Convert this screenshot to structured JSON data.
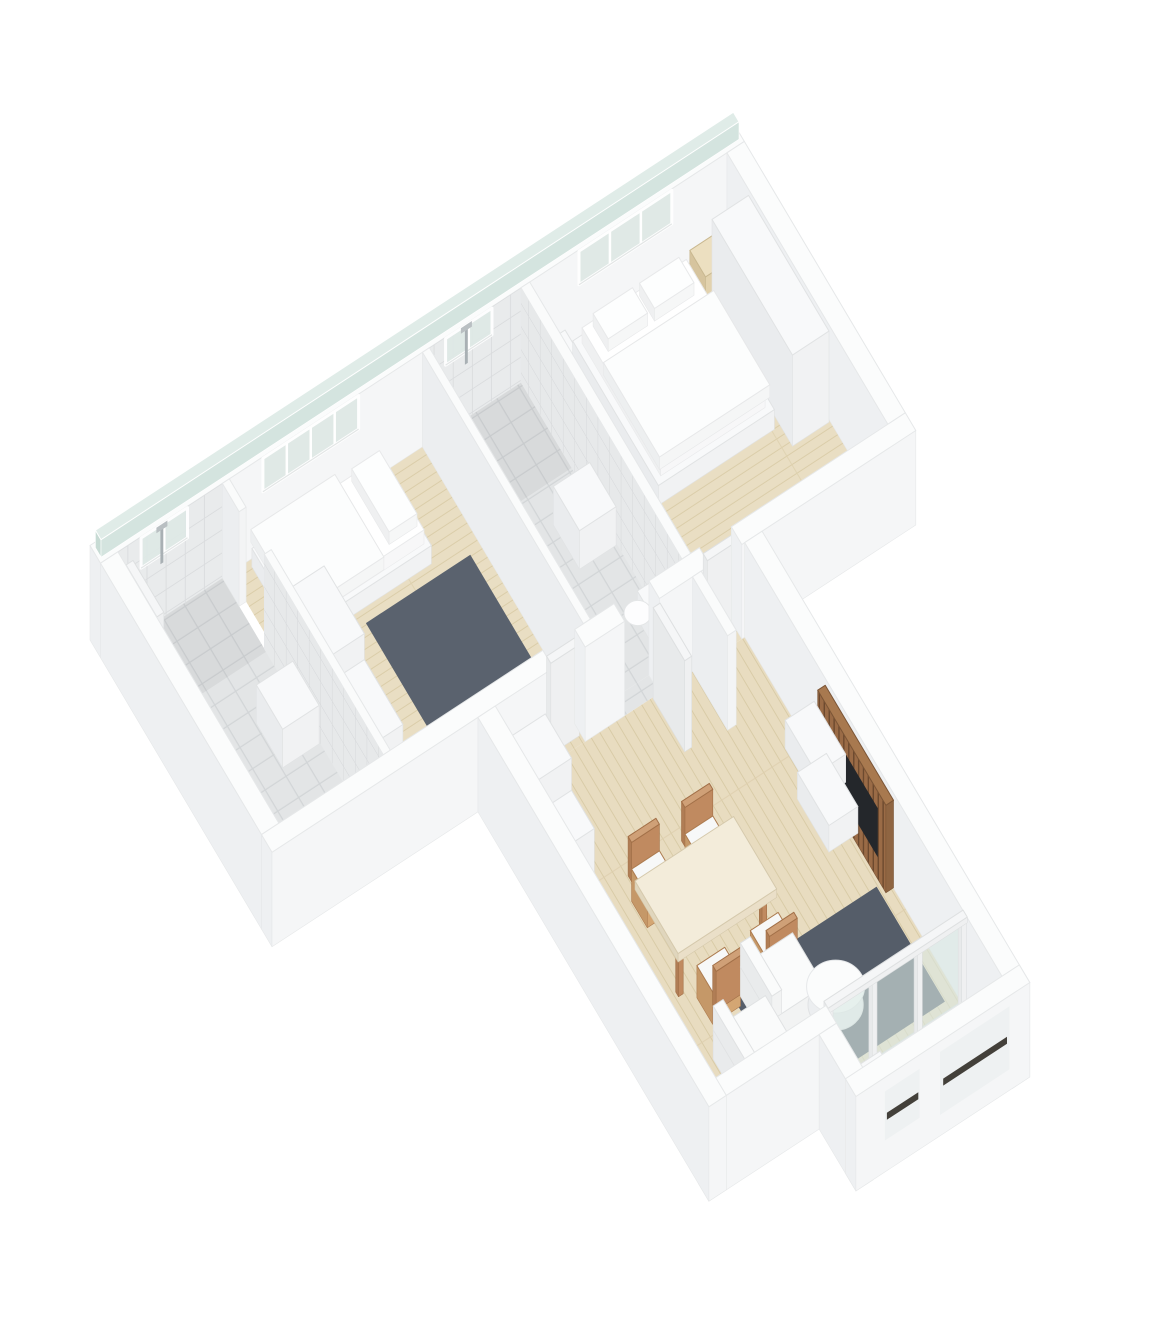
{
  "meta": {
    "title": "apartment-3d-floor-plan-render",
    "background": "#ffffff",
    "canvas": {
      "w": 1170,
      "h": 1332
    },
    "depicted_rooms": [
      "bathroom-1",
      "bedroom-2",
      "bathroom-2",
      "master-bedroom",
      "entry-hallway",
      "living-dining-room",
      "loggia-balcony"
    ]
  },
  "projection": {
    "origin": [
      90,
      640
    ],
    "eu": [
      58,
      -38
    ],
    "ev": [
      35,
      59
    ],
    "ez": 70
  },
  "palette": {
    "fills": {
      "tile": "url(#tileF)",
      "tileD": "url(#tileFd)",
      "woodU": "url(#woodU)",
      "woodV": "url(#woodV)",
      "deck": "url(#deck)",
      "rug": "#5a626e",
      "rug2": "#555d69",
      "tileWV": "url(#tileWV)",
      "tileWU": "url(#tileWU)",
      "glassP": "#d9e7e3"
    },
    "styles": {
      "ext": {
        "t": "#fbfcfc",
        "m": "#eef0f2",
        "p": "#f5f6f7",
        "s": "#e6e8e9"
      },
      "wallI": {
        "t": "#fafbfb",
        "m": "#eceef0",
        "p": "#f3f4f5",
        "s": "#e6e8e9"
      },
      "furn": {
        "t": "#f8f9fa",
        "m": "#eaecee",
        "p": "#f1f2f3",
        "s": "#e1e3e4"
      },
      "doorw": {
        "t": "#f5f6f7",
        "m": "#e8eaeb",
        "p": "#eff0f1",
        "s": "#dee0e1"
      },
      "bedw": {
        "t": "#ffffff",
        "m": "#eff0f1",
        "p": "#f7f7f8",
        "s": "#e9eaeb"
      },
      "duv": {
        "t": "#fcfdfd",
        "m": "#edeff0",
        "p": "#f5f6f6",
        "s": "#e7e8e9"
      },
      "pil": {
        "t": "#fdfefe",
        "m": "#eff0f1",
        "p": "#f6f7f7",
        "s": "#e8e9ea"
      },
      "woodf": {
        "t": "#ecdfc0",
        "m": "#d6c49e",
        "p": "#e2d2ae",
        "s": "#c9b890"
      },
      "tan": {
        "t": "#cfa077",
        "m": "#b07d55",
        "p": "#c08a60",
        "s": "#a27048"
      },
      "chair": {
        "t": "#f7f8f8",
        "m": "#c59868",
        "p": "#d4a673",
        "s": "#ad7c50"
      },
      "cloth": {
        "t": "#f3ecda",
        "m": "#e0d6bd",
        "p": "#eadfc8",
        "s": "#d5c9ac"
      },
      "sofaw": {
        "t": "#fafbfb",
        "m": "#e9ebec",
        "p": "#f2f3f3",
        "s": "#e0e2e3"
      },
      "slat": {
        "t": "#a8794f",
        "m": "url(#slats)",
        "p": "#8f6542",
        "s": "#7b5536"
      },
      "glassS": {
        "t": "#e0ece8",
        "m": "#c7dbd4",
        "p": "#d4e4df",
        "s": "#ffffff"
      }
    },
    "window": {
      "glass": "#dfe9e6",
      "frame": "#ffffff",
      "sill": "#e3e6e6"
    }
  },
  "scene": [
    [
      "floor",
      "bathroom1-floor",
      0.3,
      0.3,
      2.1,
      4.9,
      "tile"
    ],
    [
      "floor",
      "bathroom1-shower-floor",
      0.3,
      0.3,
      2.1,
      1.55,
      "tileD"
    ],
    [
      "floor",
      "bedroom2-floor",
      2.22,
      0.3,
      5.55,
      4.9,
      "woodU"
    ],
    [
      "floor",
      "bathroom2-floor",
      5.67,
      0.3,
      7.25,
      4.9,
      "tile"
    ],
    [
      "floor",
      "bathroom2-shower-floor",
      5.67,
      0.3,
      7.25,
      1.75,
      "tileD"
    ],
    [
      "floor",
      "master-bedroom-floor",
      7.4,
      0.3,
      10.8,
      4.9,
      "woodU"
    ],
    [
      "floor",
      "hall-living-floor",
      3.85,
      5.2,
      8.15,
      11.5,
      "woodV"
    ],
    [
      "floor",
      "doorway-strip-bedroom2",
      4.85,
      4.9,
      5.4,
      5.2,
      "woodV"
    ],
    [
      "floor",
      "doorway-strip-bathroom2",
      6.08,
      4.9,
      6.68,
      5.2,
      "tile"
    ],
    [
      "floor",
      "doorway-strip-master",
      7.55,
      4.9,
      8.1,
      5.2,
      "woodU"
    ],
    [
      "floor",
      "loggia-deck",
      5.75,
      11.5,
      8.15,
      12.55,
      "deck"
    ],
    [
      "floor",
      "bedroom2-rug",
      3.55,
      2.0,
      5.35,
      4.45,
      "rug"
    ],
    [
      "floor",
      "living-room-rug",
      5.35,
      9.3,
      7.95,
      11.25,
      "rug2"
    ],
    [
      "box",
      "north-wall",
      0,
      0,
      11.1,
      0.3,
      0,
      1.35,
      "ext"
    ],
    [
      "box",
      "glass-strip",
      0.05,
      0.07,
      11.05,
      0.23,
      1.35,
      1.6,
      "glassS"
    ],
    [
      "faceV",
      "bathroom1-wall-tiles",
      0.3,
      0.3,
      0,
      2.1,
      1.35,
      "tileWV",
      1
    ],
    [
      "faceV",
      "bathroom2-wall-tiles",
      0.3,
      5.67,
      0,
      7.25,
      1.35,
      "tileWV",
      1
    ],
    [
      "winV",
      "bathroom1-window",
      0.3,
      0.7,
      1.5,
      0.9,
      1.33,
      1
    ],
    [
      "winV",
      "bedroom2-window",
      0.3,
      2.8,
      4.45,
      0.85,
      1.33,
      3
    ],
    [
      "winV",
      "bathroom2-window",
      0.3,
      5.95,
      6.75,
      0.95,
      1.33,
      1
    ],
    [
      "winV",
      "master-bedroom-window",
      0.3,
      8.25,
      9.85,
      0.85,
      1.33,
      2
    ],
    [
      "faceV",
      "shower-rod-bathroom1",
      0.305,
      1.03,
      0.78,
      1.08,
      1.32,
      "#a9b0b4",
      1
    ],
    [
      "faceV",
      "shower-head-bathroom1",
      0.305,
      0.96,
      1.26,
      1.15,
      1.34,
      "#b9bfc2",
      1
    ],
    [
      "faceV",
      "shower-rod-bathroom2",
      0.305,
      6.28,
      0.78,
      6.33,
      1.32,
      "#a9b0b4",
      1
    ],
    [
      "faceV",
      "shower-head-bathroom2",
      0.305,
      6.21,
      1.26,
      6.4,
      1.34,
      "#b9bfc2",
      1
    ],
    [
      "box",
      "east-wall",
      10.8,
      0.3,
      11.1,
      4.9,
      0,
      1.35,
      "ext"
    ],
    [
      "box",
      "master-nightstand-left",
      7.55,
      0.4,
      7.95,
      0.85,
      0,
      0.45,
      "furn"
    ],
    [
      "box",
      "master-nightstand-right",
      10.1,
      0.4,
      10.5,
      0.85,
      0,
      0.42,
      "woodf"
    ],
    [
      "box",
      "master-wardrobe",
      10.15,
      0.95,
      10.78,
      3.25,
      0,
      1.3,
      "furn"
    ],
    [
      "box",
      "master-bed-frame",
      8.05,
      0.45,
      10.05,
      2.9,
      0,
      0.28,
      "furn"
    ],
    [
      "box",
      "master-bed-mattress",
      8.15,
      0.55,
      9.95,
      2.8,
      0.28,
      0.5,
      "bedw"
    ],
    [
      "box",
      "master-bed-pillow-left",
      8.3,
      0.62,
      8.98,
      1.05,
      0.5,
      0.68,
      "pil"
    ],
    [
      "box",
      "master-bed-pillow-right",
      9.1,
      0.62,
      9.78,
      1.05,
      0.5,
      0.68,
      "pil"
    ],
    [
      "box",
      "master-bed-duvet",
      8.1,
      1.25,
      10.0,
      2.85,
      0.44,
      0.62,
      "duv"
    ],
    [
      "box",
      "master-dresser",
      8.35,
      4.3,
      9.6,
      4.88,
      0,
      0.5,
      "furn"
    ],
    [
      "box",
      "bathroom2-master-wall",
      7.25,
      0.3,
      7.4,
      4.9,
      0,
      1.35,
      "wallI"
    ],
    [
      "faceU",
      "bathroom2-wall-tiles-east",
      7.25,
      0.3,
      0,
      4.9,
      1.35,
      "tileWU",
      1
    ],
    [
      "box",
      "bathroom2-vanity",
      6.6,
      2.3,
      7.23,
      3.05,
      0,
      0.55,
      "furn"
    ],
    [
      "box",
      "bathroom2-toilet-tank",
      6.95,
      4.12,
      7.22,
      4.58,
      0,
      0.4,
      "furn"
    ],
    [
      "ell",
      "bathroom2-toilet-bowl",
      6.82,
      4.35,
      0.35,
      0.2,
      "#fdfdfe",
      "#e4e6e7"
    ],
    [
      "box",
      "bedroom2-bathroom2-wall",
      5.55,
      0.3,
      5.67,
      4.9,
      0,
      1.35,
      "wallI"
    ],
    [
      "box",
      "bedroom2-bed-frame",
      2.55,
      0.4,
      4.8,
      1.8,
      0,
      0.26,
      "furn"
    ],
    [
      "box",
      "bedroom2-mattress",
      2.62,
      0.48,
      4.72,
      1.72,
      0.26,
      0.46,
      "bedw"
    ],
    [
      "box",
      "bedroom2-pillow",
      4.18,
      0.55,
      4.66,
      1.62,
      0.46,
      0.64,
      "pil"
    ],
    [
      "box",
      "bedroom2-duvet",
      2.5,
      0.45,
      3.95,
      1.85,
      0.42,
      0.6,
      "duv"
    ],
    [
      "box",
      "bedroom2-wardrobe-tall",
      2.26,
      1.95,
      2.86,
      3.1,
      0,
      1.15,
      "furn"
    ],
    [
      "box",
      "bedroom2-wardrobe-low",
      2.26,
      3.1,
      2.86,
      4.2,
      0,
      0.78,
      "furn"
    ],
    [
      "box",
      "bathroom1-wall-stub",
      2.1,
      0.3,
      2.22,
      0.78,
      0,
      1.35,
      "wallI"
    ],
    [
      "box",
      "bathroom1-bedroom2-wall",
      2.1,
      1.5,
      2.22,
      4.9,
      0,
      1.35,
      "wallI"
    ],
    [
      "faceU",
      "bathroom1-wall-tiles-east",
      2.1,
      1.5,
      0,
      4.9,
      1.35,
      "tileWU",
      1
    ],
    [
      "box",
      "bathroom1-vanity",
      1.45,
      2.35,
      2.08,
      3.1,
      0,
      0.55,
      "furn"
    ],
    [
      "box",
      "bathroom1-toilet-tank",
      1.8,
      4.2,
      2.07,
      4.66,
      0,
      0.4,
      "furn"
    ],
    [
      "ell",
      "bathroom1-toilet-bowl",
      1.66,
      4.43,
      0.35,
      0.2,
      "#fdfdfe",
      "#e4e6e7"
    ],
    [
      "box",
      "bathroom1-door",
      0.32,
      0.5,
      0.44,
      1.38,
      0,
      1.32,
      "doorw"
    ],
    [
      "box",
      "west-wall",
      0,
      0.3,
      0.3,
      4.9,
      0,
      1.35,
      "ext"
    ],
    [
      "box",
      "south-wall-a",
      0,
      4.9,
      4.85,
      5.2,
      0,
      1.35,
      "ext"
    ],
    [
      "box",
      "bedroom2-door",
      4.88,
      4.96,
      5.37,
      5.08,
      0,
      1.3,
      "doorw"
    ],
    [
      "box",
      "south-wall-b",
      5.4,
      4.9,
      6.08,
      5.2,
      0,
      1.35,
      "ext"
    ],
    [
      "box",
      "south-wall-c",
      6.68,
      4.9,
      7.55,
      5.2,
      0,
      1.35,
      "ext"
    ],
    [
      "box",
      "master-door",
      7.58,
      4.96,
      8.07,
      5.08,
      0,
      1.3,
      "doorw"
    ],
    [
      "box",
      "south-wall-d",
      8.1,
      4.9,
      11.1,
      5.2,
      0,
      1.35,
      "ext"
    ],
    [
      "box",
      "hall-wall-stub",
      7.25,
      5.2,
      7.4,
      6.2,
      0,
      1.35,
      "wallI"
    ],
    [
      "box",
      "bathroom2-door-open",
      6.56,
      5.22,
      6.68,
      6.12,
      0,
      1.3,
      "doorw"
    ],
    [
      "box",
      "entry-cabinet-tall",
      3.88,
      5.55,
      4.5,
      6.3,
      0,
      1.18,
      "furn"
    ],
    [
      "box",
      "entry-cabinet-low",
      3.88,
      6.3,
      4.5,
      6.95,
      0,
      0.72,
      "furn"
    ],
    [
      "box",
      "living-east-wall",
      8.15,
      5.2,
      8.45,
      12.85,
      0,
      1.35,
      "ext"
    ],
    [
      "box",
      "tv-slat-panel",
      8.02,
      7.5,
      8.15,
      9.45,
      0,
      1.25,
      "slat"
    ],
    [
      "faceU",
      "tv-screen",
      8.0,
      8.1,
      0.35,
      9.25,
      1.05,
      "#24272b",
      1
    ],
    [
      "box",
      "tv-cabinet-upper",
      7.55,
      7.35,
      8.05,
      8.25,
      0.55,
      0.95,
      "furn"
    ],
    [
      "box",
      "tv-cabinet-lower",
      7.55,
      7.7,
      8.05,
      8.6,
      0.12,
      0.5,
      "furn"
    ],
    [
      "box",
      "dining-chair-back-n1",
      4.8,
      7.42,
      5.28,
      7.52,
      0.28,
      0.84,
      "tan"
    ],
    [
      "box",
      "dining-chair-n1",
      4.8,
      7.52,
      5.28,
      7.97,
      0,
      0.46,
      "chair"
    ],
    [
      "box",
      "dining-chair-back-n2",
      5.72,
      7.42,
      6.2,
      7.52,
      0.28,
      0.84,
      "tan"
    ],
    [
      "box",
      "dining-chair-n2",
      5.72,
      7.52,
      6.2,
      7.97,
      0,
      0.46,
      "chair"
    ],
    [
      "box",
      "dining-table-leg-a",
      4.68,
      8.98,
      4.76,
      9.06,
      0,
      0.66,
      "tan"
    ],
    [
      "box",
      "dining-table-leg-b",
      6.12,
      8.98,
      6.2,
      9.06,
      0,
      0.66,
      "tan"
    ],
    [
      "box",
      "dining-table",
      4.6,
      7.95,
      6.3,
      9.18,
      0.64,
      0.76,
      "cloth"
    ],
    [
      "box",
      "dining-chair-s1",
      4.9,
      9.22,
      5.38,
      9.67,
      0,
      0.46,
      "chair"
    ],
    [
      "box",
      "dining-chair-back-s1",
      4.9,
      9.67,
      5.38,
      9.77,
      0.28,
      0.84,
      "tan"
    ],
    [
      "box",
      "dining-chair-s2",
      5.82,
      9.22,
      6.3,
      9.67,
      0,
      0.46,
      "chair"
    ],
    [
      "box",
      "dining-chair-back-s2",
      5.82,
      9.67,
      6.3,
      9.77,
      0.28,
      0.84,
      "tan"
    ],
    [
      "box",
      "sofa-module-a",
      5.45,
      9.55,
      6.35,
      10.45,
      0,
      0.42,
      "sofaw"
    ],
    [
      "box",
      "sofa-back-a",
      5.45,
      9.55,
      5.62,
      10.45,
      0.42,
      0.76,
      "sofaw"
    ],
    [
      "box",
      "sofa-module-b",
      4.65,
      10.1,
      5.55,
      11.0,
      0,
      0.42,
      "sofaw"
    ],
    [
      "box",
      "sofa-back-b",
      4.65,
      10.1,
      4.82,
      11.0,
      0.42,
      0.76,
      "sofaw"
    ],
    [
      "ell",
      "coffee-table-base",
      6.55,
      10.45,
      0.04,
      0.4,
      "#eceef0",
      "#e0e2e4"
    ],
    [
      "ell",
      "coffee-table-top",
      6.55,
      10.45,
      0.3,
      0.42,
      "#fbfcfc",
      "#e6e8ea"
    ],
    [
      "box",
      "loggia-door-rail",
      5.75,
      11.44,
      8.15,
      11.56,
      0,
      0.07,
      "doorw"
    ],
    [
      "faceV",
      "loggia-door-glass",
      11.5,
      5.78,
      0.07,
      8.12,
      1.3,
      "glassP",
      0.6
    ],
    [
      "box",
      "loggia-door-mullion-1",
      5.76,
      11.45,
      5.84,
      11.55,
      0,
      1.33,
      "doorw"
    ],
    [
      "box",
      "loggia-door-mullion-2",
      6.52,
      11.45,
      6.6,
      11.55,
      0,
      1.33,
      "doorw"
    ],
    [
      "box",
      "loggia-door-mullion-3",
      7.3,
      11.45,
      7.38,
      11.55,
      0,
      1.33,
      "doorw"
    ],
    [
      "box",
      "loggia-door-mullion-4",
      8.06,
      11.45,
      8.14,
      11.55,
      0,
      1.33,
      "doorw"
    ],
    [
      "box",
      "loggia-door-head",
      5.75,
      11.44,
      8.15,
      11.56,
      1.28,
      1.36,
      "doorw"
    ],
    [
      "box",
      "loggia-planter-a",
      5.95,
      11.72,
      6.55,
      12.1,
      0,
      0.45,
      "furn"
    ],
    [
      "box",
      "loggia-planter-b",
      7.7,
      11.85,
      8.12,
      12.3,
      0,
      0.5,
      "furn"
    ],
    [
      "box",
      "living-south-wall",
      3.55,
      11.5,
      5.75,
      11.8,
      0,
      1.35,
      "ext"
    ],
    [
      "box",
      "west-wing-wall",
      3.55,
      5.2,
      3.85,
      11.8,
      0,
      1.35,
      "ext"
    ],
    [
      "box",
      "loggia-west-wall",
      5.45,
      11.8,
      5.75,
      12.85,
      0,
      1.35,
      "ext"
    ],
    [
      "box",
      "loggia-south-wall",
      5.45,
      12.55,
      8.45,
      12.85,
      0,
      1.35,
      "ext"
    ],
    [
      "faceV",
      "loggia-window-small",
      12.85,
      5.95,
      0.45,
      6.55,
      1.15,
      "#eef1f2",
      1
    ],
    [
      "faceV",
      "loggia-window-small-slot",
      12.86,
      5.98,
      0.74,
      6.52,
      0.84,
      "#43403a",
      1
    ],
    [
      "faceV",
      "loggia-window-large",
      12.85,
      6.9,
      0.3,
      8.1,
      1.2,
      "#eef1f2",
      1
    ],
    [
      "faceV",
      "loggia-window-large-slot",
      12.86,
      6.95,
      0.7,
      8.05,
      0.8,
      "#43403a",
      1
    ]
  ]
}
